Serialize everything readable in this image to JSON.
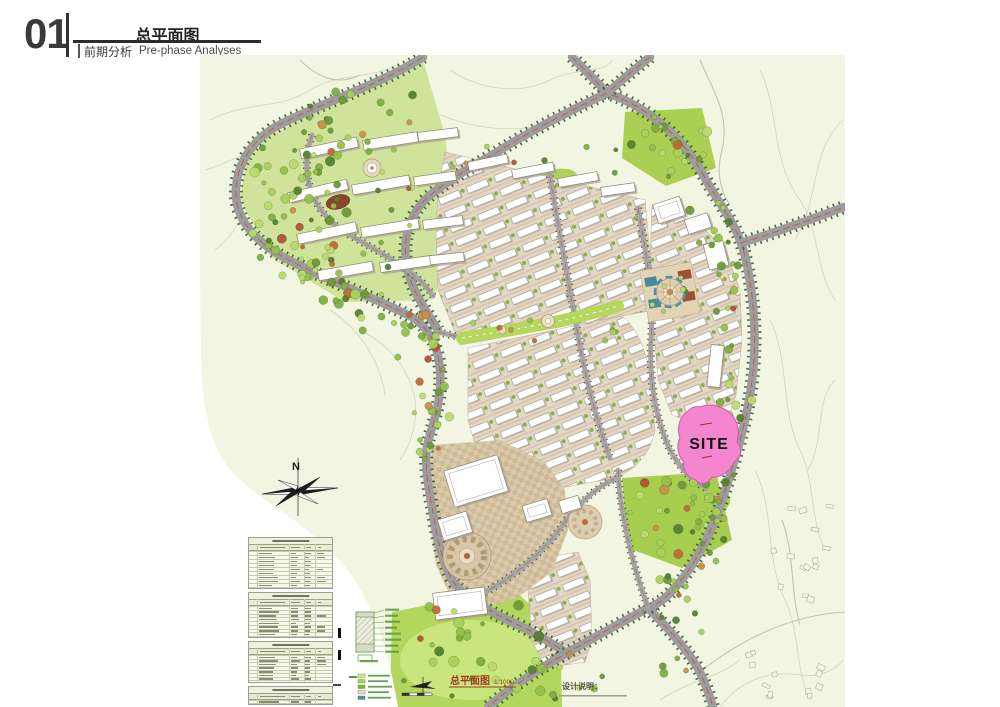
{
  "header": {
    "section_number": "01",
    "page_title": "总平面图",
    "section_title_cn": "前期分析",
    "section_title_en": "Pre-phase Analyses"
  },
  "map": {
    "site_label": "SITE",
    "compass_label": "N",
    "caption_title": "总平面图",
    "caption_scale": "1:1000",
    "notes_heading": "设计说明："
  },
  "colors": {
    "site_pink": "#F383CE",
    "road_gray": "#9C9C9C",
    "tree_line_green": "#3F5A33",
    "lawn_green": "#AFD457",
    "map_background": "#F2F5E2",
    "caption_red": "#9E3B22"
  }
}
